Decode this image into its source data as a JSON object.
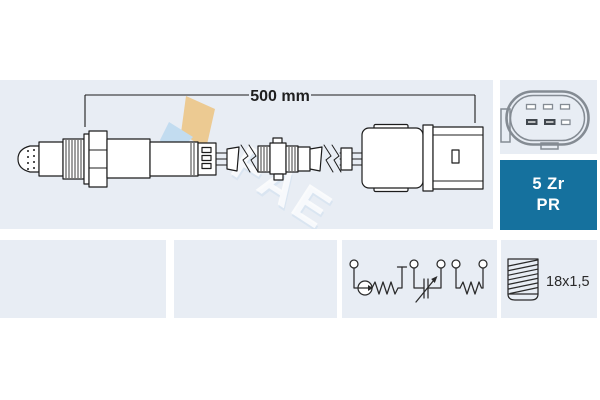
{
  "colors": {
    "panel_bg": "#e8edf4",
    "badge_bg": "#15719e",
    "line": "#1c1c1c",
    "schematic_line": "#2a2a2a",
    "connector_gray": "#848b93",
    "logo_tan": "#ecca92",
    "logo_blue": "#c2dcf0"
  },
  "diagram": {
    "dimension_label": "500 mm",
    "thread_size_label": "18x1,5",
    "badge": {
      "line1": "5 Zr",
      "line2": "PR"
    },
    "watermark_text": "FAE"
  }
}
